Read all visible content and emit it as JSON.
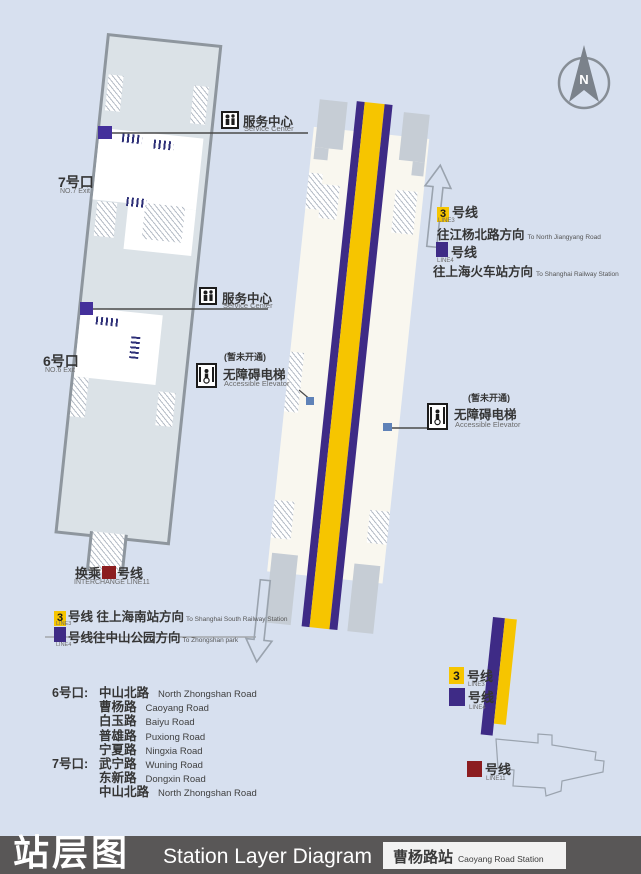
{
  "titlebar": {
    "title_cn": "站层图",
    "title_en": "Station Layer Diagram",
    "station_cn": "曹杨路站",
    "station_en": "Caoyang Road Station"
  },
  "compass": {
    "label": "N"
  },
  "exit_markers": {
    "exit7_cn": "7号口",
    "exit7_en": "NO.7 Exit",
    "exit6_cn": "6号口",
    "exit6_en": "NO.6 Exit"
  },
  "service_centers": [
    {
      "cn": "服务中心",
      "en": "Service Center"
    },
    {
      "cn": "服务中心",
      "en": "Service Center"
    }
  ],
  "elevators": [
    {
      "note": "(暂未开通)",
      "cn": "无障碍电梯",
      "en": "Accessible Elevator"
    },
    {
      "note": "(暂未开通)",
      "cn": "无障碍电梯",
      "en": "Accessible Elevator"
    }
  ],
  "interchange": {
    "cn_prefix": "换乘",
    "cn_suffix": "号线",
    "en": "INTERCHANGE LINE11"
  },
  "directions_north": [
    {
      "badge": "3",
      "suffix_cn": "号线",
      "line_en": "LINE3",
      "dest_cn": "往江杨北路方向",
      "dest_en": "To North Jiangyang Road"
    },
    {
      "badge": "",
      "suffix_cn": "号线",
      "line_en": "LINE4",
      "dest_cn": "往上海火车站方向",
      "dest_en": "To Shanghai Railway Station"
    }
  ],
  "directions_south": [
    {
      "badge": "3",
      "text_cn": "号线 往上海南站方向",
      "line_en": "LINE3",
      "dest_en": "To Shanghai South Railway Station"
    },
    {
      "badge": "",
      "text_cn": "号线往中山公园方向",
      "line_en": "LINE4",
      "dest_en": "To Zhongshan park"
    }
  ],
  "exit_roads": [
    {
      "prefix": "6号口:",
      "cn": "中山北路",
      "en": "North Zhongshan Road"
    },
    {
      "prefix": "",
      "cn": "曹杨路",
      "en": "Caoyang Road"
    },
    {
      "prefix": "",
      "cn": "白玉路",
      "en": "Baiyu Road"
    },
    {
      "prefix": "",
      "cn": "普雄路",
      "en": "Puxiong Road"
    },
    {
      "prefix": "",
      "cn": "宁夏路",
      "en": "Ningxia Road"
    },
    {
      "prefix": "7号口:",
      "cn": "武宁路",
      "en": "Wuning Road"
    },
    {
      "prefix": "",
      "cn": "东新路",
      "en": "Dongxin Road"
    },
    {
      "prefix": "",
      "cn": "中山北路",
      "en": "North Zhongshan Road"
    }
  ],
  "legend": [
    {
      "badge": "3",
      "cn": "号线",
      "en": "LINE3",
      "color": "#f6c500"
    },
    {
      "badge": "",
      "cn": "号线",
      "en": "LINE4",
      "color": "#3e2b86"
    },
    {
      "badge": "",
      "cn": "号线",
      "en": "LINE11",
      "color": "#8c1d20"
    }
  ],
  "colors": {
    "background": "#d7e0ef",
    "line3_yellow": "#f6c500",
    "line4_purple": "#3e2b86",
    "line11_red": "#8c1d20",
    "title_bar": "#595757"
  }
}
